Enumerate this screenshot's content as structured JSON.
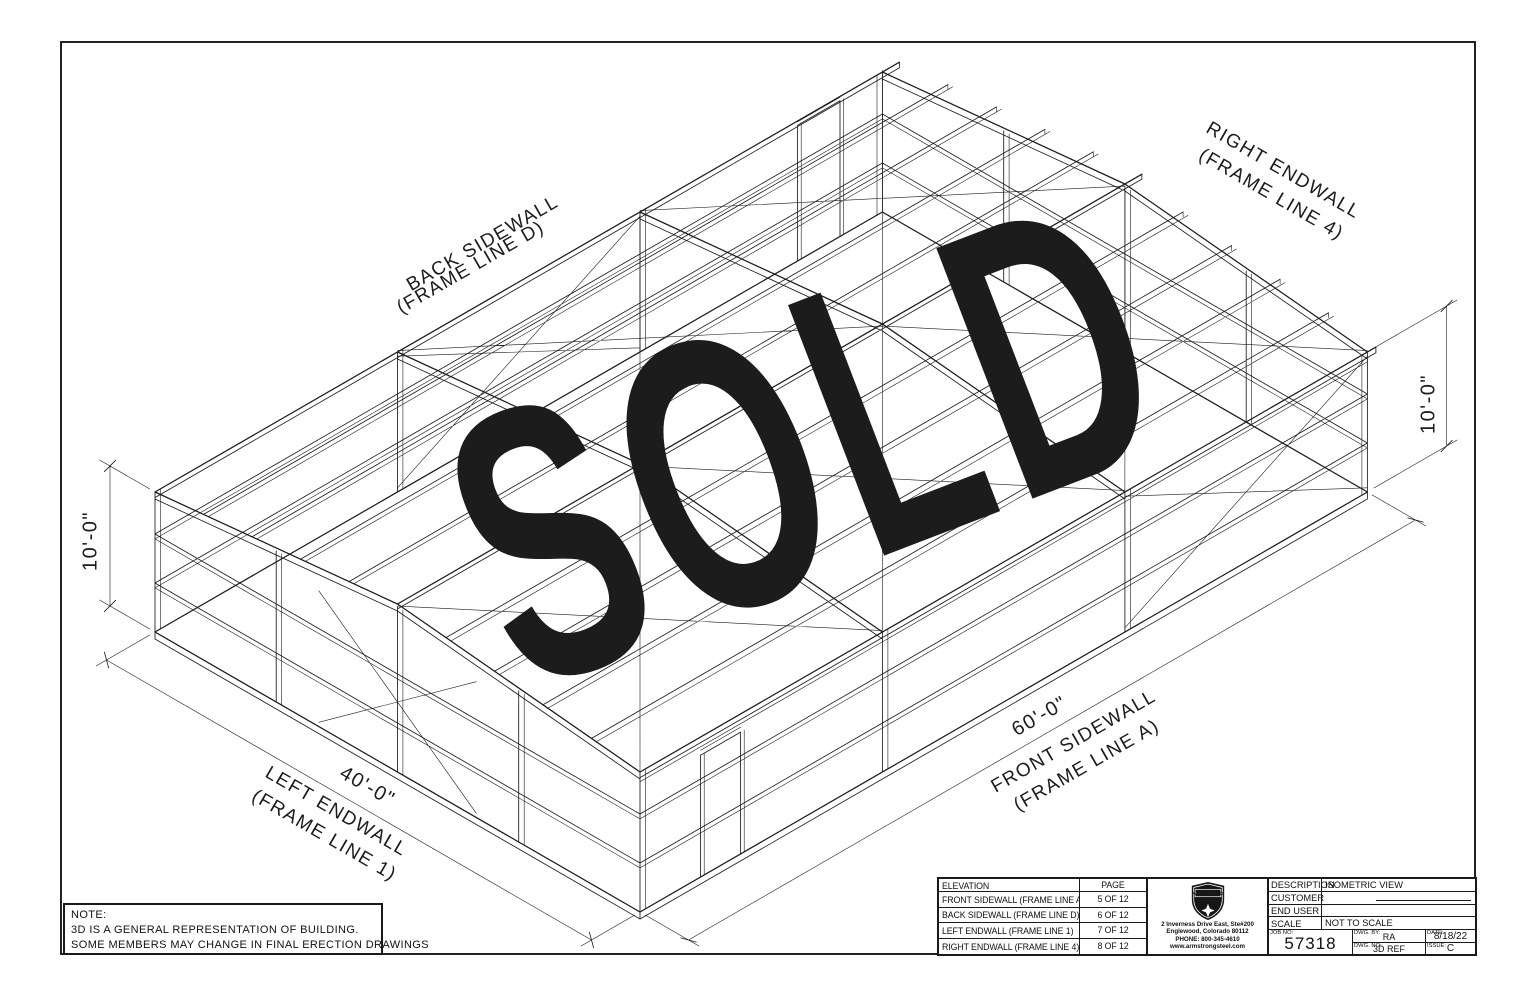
{
  "sold": {
    "text": "SOLD",
    "color": "#E6000F"
  },
  "drawing": {
    "wall_labels": {
      "back_sidewall_line1": "BACK SIDEWALL",
      "back_sidewall_line2": "(FRAME LINE D)",
      "right_endwall_line1": "RIGHT ENDWALL",
      "right_endwall_line2": "(FRAME LINE 4)",
      "left_endwall_line1": "LEFT ENDWALL",
      "left_endwall_line2": "(FRAME LINE 1)",
      "front_sidewall_line1": "FRONT SIDEWALL",
      "front_sidewall_line2": "(FRAME LINE A)"
    },
    "dimensions": {
      "left_height": "10'-0\"",
      "right_height": "10'-0\"",
      "endwall_width": "40'-0\"",
      "sidewall_length": "60'-0\""
    }
  },
  "note": {
    "title": "NOTE:",
    "line1": "3D IS A GENERAL REPRESENTATION OF BUILDING.",
    "line2": "SOME MEMBERS MAY CHANGE IN FINAL ERECTION DRAWINGS"
  },
  "title_block": {
    "elevation_table": {
      "headers": [
        "ELEVATION",
        "PAGE"
      ],
      "rows": [
        {
          "elevation": "FRONT SIDEWALL (FRAME LINE A)",
          "page": "5 OF 12"
        },
        {
          "elevation": "BACK SIDEWALL (FRAME LINE D)",
          "page": "6 OF 12"
        },
        {
          "elevation": "LEFT ENDWALL (FRAME LINE 1)",
          "page": "7 OF 12"
        },
        {
          "elevation": "RIGHT ENDWALL (FRAME LINE 4)",
          "page": "8 OF 12"
        }
      ]
    },
    "company": {
      "logo_name_top": "ARMSTRONG",
      "logo_name_bottom": "STEEL",
      "address1": "2 Inverness Drive East, Ste#200",
      "address2": "Englewood, Colorado 80112",
      "phone": "PHONE: 800-345-4610",
      "website": "www.armstrongsteel.com"
    },
    "fields": {
      "description_label": "DESCRIPTION",
      "description": "ISOMETRIC VIEW",
      "customer_label": "CUSTOMER",
      "customer": "",
      "end_user_label": "END USER",
      "end_user": "",
      "scale_label": "SCALE",
      "scale": "NOT TO SCALE",
      "job_no_label": "JOB NO:",
      "job_no": "57318",
      "dwg_by_label": "DWG. BY:",
      "dwg_by": "RA",
      "dwg_no_label": "DWG. NO:",
      "dwg_no": "3D REF",
      "date_label": "DATE:",
      "date": "8/18/22",
      "issue_label": "ISSUE:",
      "issue": "C"
    }
  }
}
